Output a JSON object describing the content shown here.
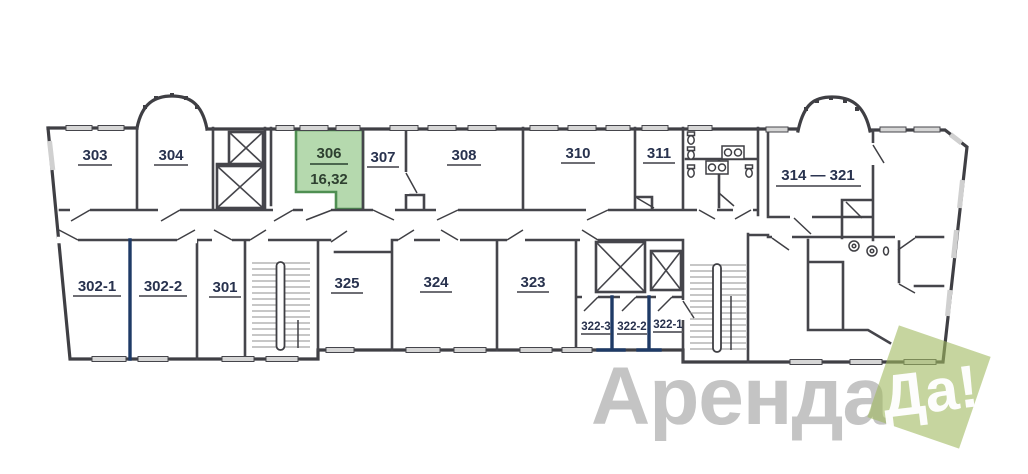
{
  "page": {
    "background": "#ffffff"
  },
  "floorplan": {
    "highlighted_room": {
      "number": "306",
      "area": "16,32",
      "fill": "#b5d9ae",
      "border": "#4f8f52"
    },
    "rooms": {
      "r303": "303",
      "r304": "304",
      "r307": "307",
      "r308": "308",
      "r310": "310",
      "r311": "311",
      "r314_321": "314 — 321",
      "r302_1": "302-1",
      "r302_2": "302-2",
      "r301": "301",
      "r325": "325",
      "r324": "324",
      "r323": "323",
      "r322_3": "322-3",
      "r322_2": "322-2",
      "r322_1": "322-1"
    },
    "wall_color": "#3f3f44",
    "divider_color": "#1e3a66"
  },
  "watermark": {
    "text_main": "Аренда",
    "text_badge": "Да!",
    "main_color": "#9e9e9e",
    "badge_bg": "#a0b95f",
    "badge_text_color": "#ffffff"
  }
}
